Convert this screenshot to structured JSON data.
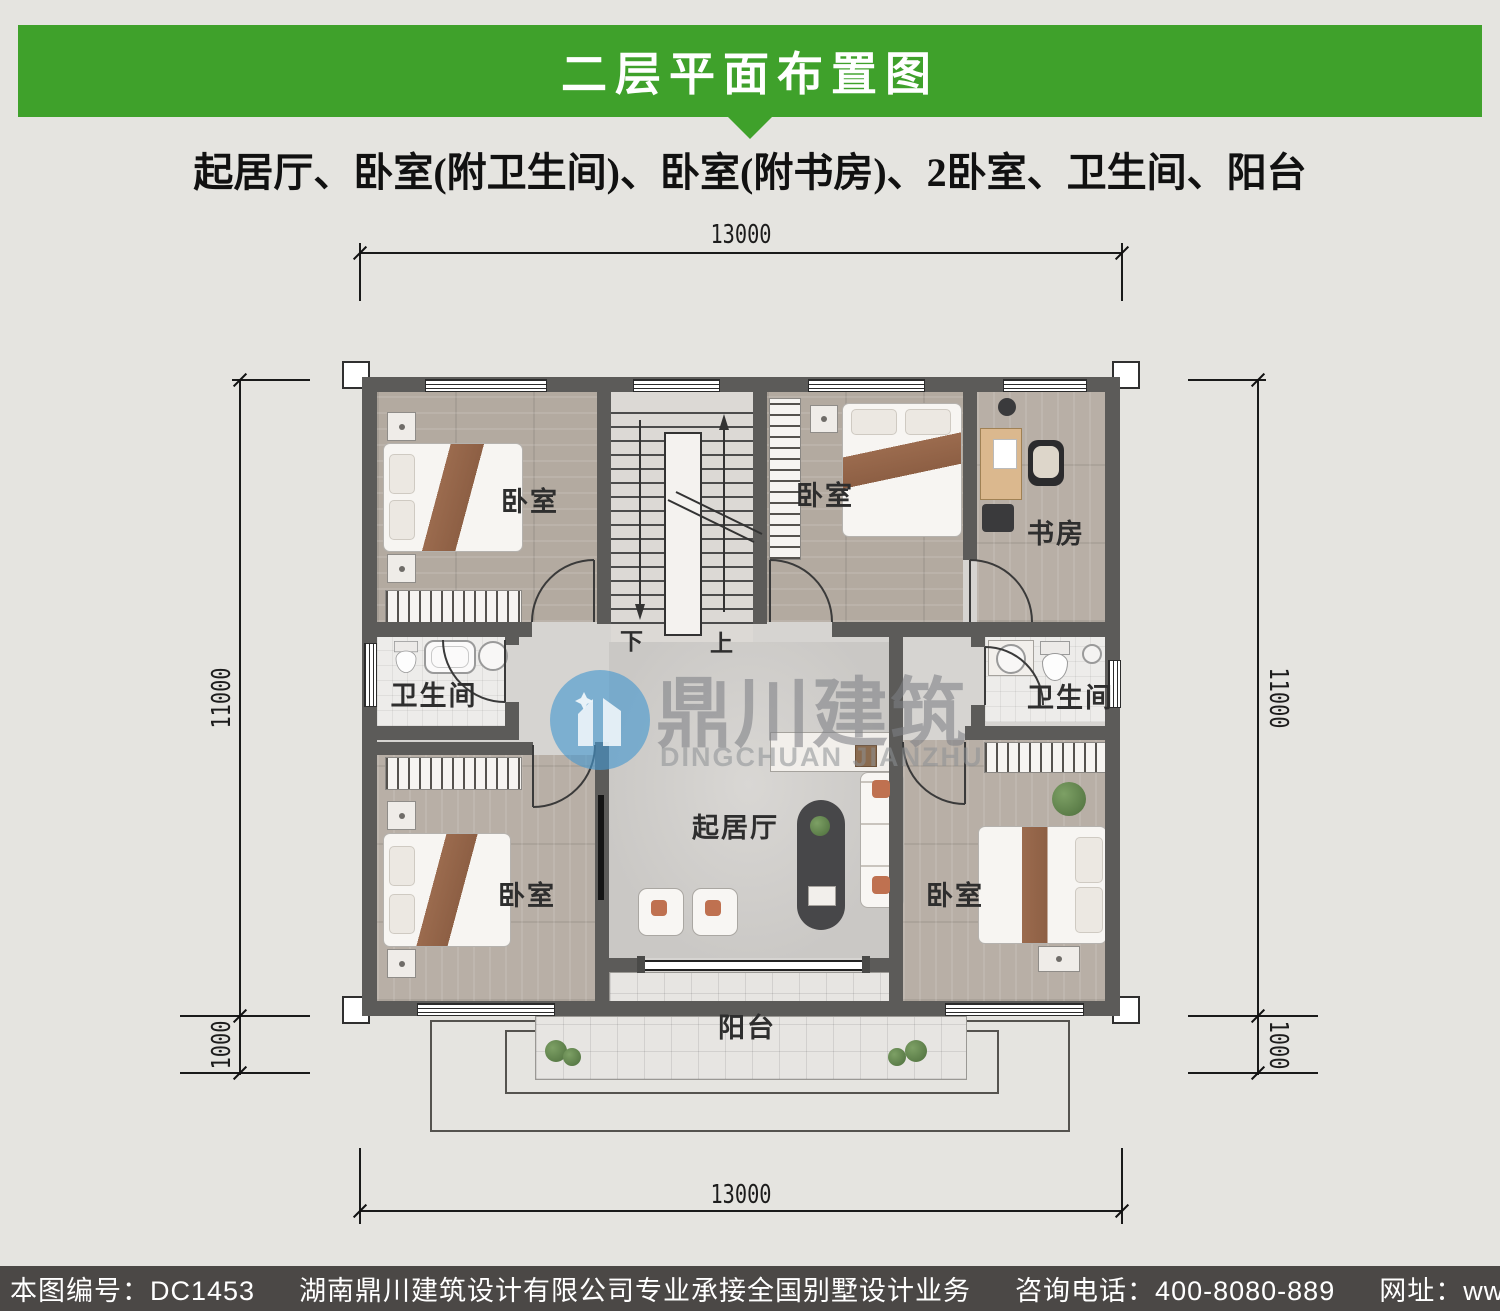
{
  "header": {
    "title": "二层平面布置图",
    "subtitle": "起居厅、卧室(附卫生间)、卧室(附书房)、2卧室、卫生间、阳台"
  },
  "plan": {
    "rooms": [
      {
        "id": "bedroom-top-left",
        "label": "卧室"
      },
      {
        "id": "bedroom-top-mid",
        "label": "卧室"
      },
      {
        "id": "study",
        "label": "书房"
      },
      {
        "id": "bath-left",
        "label": "卫生间"
      },
      {
        "id": "bath-right",
        "label": "卫生间"
      },
      {
        "id": "bedroom-bottom-left",
        "label": "卧室"
      },
      {
        "id": "living-room",
        "label": "起居厅"
      },
      {
        "id": "bedroom-bottom-right",
        "label": "卧室"
      },
      {
        "id": "balcony",
        "label": "阳台"
      }
    ],
    "stairs": {
      "down": "下",
      "up": "上"
    },
    "dimensions": {
      "top": "13000",
      "bottom": "13000",
      "side_main": "11000",
      "side_balcony": "1000"
    }
  },
  "watermark": {
    "cn": "鼎川建筑",
    "en": "DINGCHUAN JIANZHU"
  },
  "footer": {
    "plan_no": "本图编号：DC1453",
    "company": "湖南鼎川建筑设计有限公司专业承接全国别墅设计业务",
    "phone": "咨询电话：400-8080-889",
    "website": "网址：www.bstzcs.com"
  },
  "colors": {
    "accent_green": "#3fa12b",
    "footer_bg": "#4b4846",
    "wall": "#5c5b59",
    "watermark_blue": "#4697cf"
  }
}
